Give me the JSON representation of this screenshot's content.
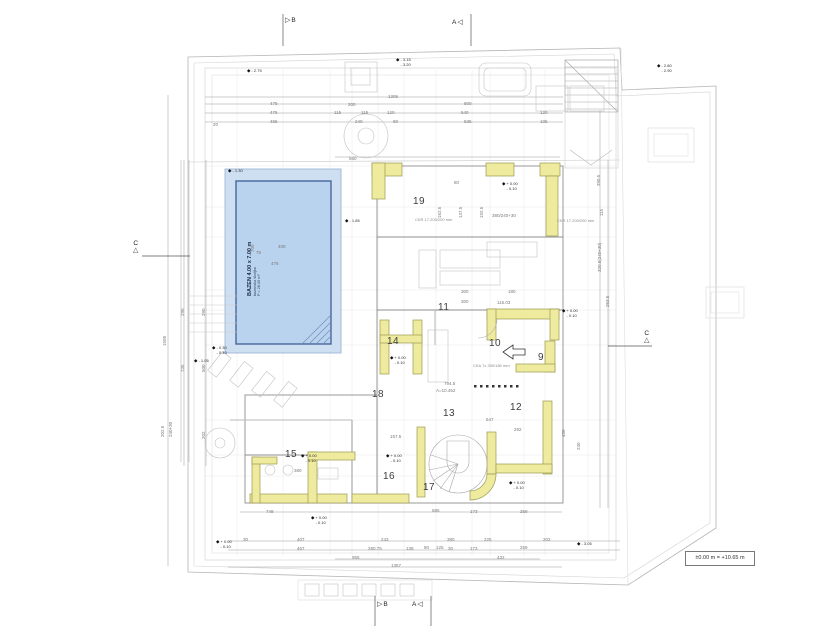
{
  "icons": {
    "level": "◆",
    "flag_right": "▷",
    "flag_left": "◁",
    "triangle_up": "△"
  },
  "drawing": {
    "pool": {
      "title": "BAZEN  4.00 x 7.00 m",
      "subtitle": "bazenska školjka",
      "area": "P = 28.00 m²"
    },
    "datum": {
      "label": "±0.00 m = +10.65 m"
    },
    "rooms": [
      {
        "n": "19",
        "x": 413,
        "y": 196
      },
      {
        "n": "11",
        "x": 438,
        "y": 302
      },
      {
        "n": "14",
        "x": 387,
        "y": 336
      },
      {
        "n": "10",
        "x": 489,
        "y": 338
      },
      {
        "n": "9",
        "x": 538,
        "y": 352
      },
      {
        "n": "18",
        "x": 372,
        "y": 389
      },
      {
        "n": "13",
        "x": 443,
        "y": 408
      },
      {
        "n": "12",
        "x": 510,
        "y": 402
      },
      {
        "n": "15",
        "x": 285,
        "y": 449
      },
      {
        "n": "16",
        "x": 383,
        "y": 471
      },
      {
        "n": "17",
        "x": 423,
        "y": 482
      }
    ],
    "section_markers": [
      {
        "label": "B",
        "icon": "flag_right",
        "x": 285,
        "y": 17
      },
      {
        "label": "A",
        "icon": "flag_left",
        "x": 452,
        "y": 19,
        "flip": true
      },
      {
        "label": "B",
        "icon": "flag_right",
        "x": 377,
        "y": 601
      },
      {
        "label": "A",
        "icon": "flag_left",
        "x": 412,
        "y": 601,
        "flip": true
      },
      {
        "label": "C",
        "icon": "triangle_up",
        "x": 133,
        "y": 240,
        "vert": true
      },
      {
        "label": "C",
        "icon": "triangle_up",
        "x": 644,
        "y": 330,
        "vert": true
      }
    ],
    "level_markers": [
      {
        "l1": "- 2.75",
        "x": 247,
        "y": 69
      },
      {
        "l1": "- 3.15",
        "l2": "- 3.20",
        "x": 396,
        "y": 58
      },
      {
        "l1": "- 2.80",
        "l2": "- 2.90",
        "x": 657,
        "y": 64
      },
      {
        "l1": "- 1.30",
        "x": 228,
        "y": 169
      },
      {
        "l1": "- 1.85",
        "x": 345,
        "y": 219
      },
      {
        "l1": "+ 0.00",
        "l2": "- 0.10",
        "x": 502,
        "y": 182
      },
      {
        "l1": "+ 0.00",
        "l2": "- 0.10",
        "x": 562,
        "y": 309
      },
      {
        "l1": "+ 0.00",
        "l2": "- 0.10",
        "x": 390,
        "y": 356
      },
      {
        "l1": "- 0.30",
        "l2": "- 0.40",
        "x": 212,
        "y": 346
      },
      {
        "l1": "- 1.05",
        "x": 194,
        "y": 359
      },
      {
        "l1": "+ 0.00",
        "l2": "- 0.10",
        "x": 301,
        "y": 454
      },
      {
        "l1": "+ 0.00",
        "l2": "- 0.10",
        "x": 386,
        "y": 454
      },
      {
        "l1": "+ 0.00",
        "l2": "- 0.10",
        "x": 509,
        "y": 481
      },
      {
        "l1": "+ 0.00",
        "l2": "- 0.10",
        "x": 311,
        "y": 516
      },
      {
        "l1": "- 3.05",
        "x": 577,
        "y": 542
      },
      {
        "l1": "+ 0.00",
        "l2": "- 0.10",
        "x": 216,
        "y": 540
      }
    ],
    "dims": [
      {
        "t": "1305",
        "x": 388,
        "y": 94
      },
      {
        "t": "475",
        "x": 270,
        "y": 101
      },
      {
        "t": "475",
        "x": 270,
        "y": 110
      },
      {
        "t": "455",
        "x": 270,
        "y": 119
      },
      {
        "t": "20",
        "x": 213,
        "y": 122
      },
      {
        "t": "200",
        "x": 348,
        "y": 102
      },
      {
        "t": "115",
        "x": 334,
        "y": 110
      },
      {
        "t": "115",
        "x": 361,
        "y": 110
      },
      {
        "t": "120",
        "x": 387,
        "y": 110
      },
      {
        "t": "240",
        "x": 355,
        "y": 119
      },
      {
        "t": "80",
        "x": 393,
        "y": 119
      },
      {
        "t": "800",
        "x": 464,
        "y": 101
      },
      {
        "t": "540",
        "x": 461,
        "y": 110
      },
      {
        "t": "535",
        "x": 464,
        "y": 119
      },
      {
        "t": "120",
        "x": 540,
        "y": 110
      },
      {
        "t": "105",
        "x": 540,
        "y": 119
      },
      {
        "t": "560",
        "x": 349,
        "y": 156
      },
      {
        "t": "80",
        "x": 454,
        "y": 180
      },
      {
        "t": "162.5",
        "x": 437,
        "y": 218,
        "r": 1
      },
      {
        "t": "137.5",
        "x": 458,
        "y": 218,
        "r": 1
      },
      {
        "t": "192.5",
        "x": 479,
        "y": 218,
        "r": 1
      },
      {
        "t": "380/240+30",
        "x": 492,
        "y": 213
      },
      {
        "t": "115.03",
        "x": 497,
        "y": 300
      },
      {
        "t": "300",
        "x": 461,
        "y": 289
      },
      {
        "t": "300",
        "x": 461,
        "y": 299
      },
      {
        "t": "180",
        "x": 508,
        "y": 289
      },
      {
        "t": "547",
        "x": 486,
        "y": 417
      },
      {
        "t": "292",
        "x": 514,
        "y": 427
      },
      {
        "t": "157.5",
        "x": 390,
        "y": 434
      },
      {
        "t": "380",
        "x": 294,
        "y": 468
      },
      {
        "t": "794.5",
        "x": 444,
        "y": 381
      },
      {
        "t": "A=10.452",
        "x": 436,
        "y": 388
      },
      {
        "t": "1508",
        "x": 162,
        "y": 346,
        "r": 1
      },
      {
        "t": "290",
        "x": 180,
        "y": 316,
        "r": 1
      },
      {
        "t": "290",
        "x": 201,
        "y": 316,
        "r": 1
      },
      {
        "t": "735",
        "x": 180,
        "y": 372,
        "r": 1
      },
      {
        "t": "500",
        "x": 201,
        "y": 372,
        "r": 1
      },
      {
        "t": "202.5",
        "x": 160,
        "y": 437,
        "r": 1
      },
      {
        "t": "240+30",
        "x": 168,
        "y": 437,
        "r": 1
      },
      {
        "t": "202",
        "x": 201,
        "y": 439,
        "r": 1
      },
      {
        "t": "700",
        "x": 250,
        "y": 252,
        "r": 1
      },
      {
        "t": "75",
        "x": 256,
        "y": 250
      },
      {
        "t": "400",
        "x": 278,
        "y": 244
      },
      {
        "t": "475",
        "x": 271,
        "y": 261
      },
      {
        "t": "390.5",
        "x": 596,
        "y": 186,
        "r": 1
      },
      {
        "t": "115",
        "x": 599,
        "y": 216,
        "r": 1
      },
      {
        "t": "320.5(240+30)",
        "x": 597,
        "y": 272,
        "r": 1
      },
      {
        "t": "263.5",
        "x": 605,
        "y": 307,
        "r": 1
      },
      {
        "t": "430",
        "x": 561,
        "y": 437,
        "r": 1
      },
      {
        "t": "240",
        "x": 576,
        "y": 450,
        "r": 1
      },
      {
        "t": "748",
        "x": 266,
        "y": 509
      },
      {
        "t": "685",
        "x": 432,
        "y": 508
      },
      {
        "t": "173",
        "x": 470,
        "y": 509
      },
      {
        "t": "259",
        "x": 520,
        "y": 509
      },
      {
        "t": "30",
        "x": 243,
        "y": 537
      },
      {
        "t": "407",
        "x": 297,
        "y": 537
      },
      {
        "t": "243",
        "x": 381,
        "y": 537
      },
      {
        "t": "380",
        "x": 447,
        "y": 537
      },
      {
        "t": "225",
        "x": 484,
        "y": 537
      },
      {
        "t": "202",
        "x": 543,
        "y": 537
      },
      {
        "t": "467",
        "x": 297,
        "y": 546
      },
      {
        "t": "280.75",
        "x": 368,
        "y": 546
      },
      {
        "t": "138",
        "x": 406,
        "y": 546
      },
      {
        "t": "80",
        "x": 424,
        "y": 545
      },
      {
        "t": "125",
        "x": 436,
        "y": 545
      },
      {
        "t": "30",
        "x": 448,
        "y": 546
      },
      {
        "t": "173",
        "x": 470,
        "y": 546
      },
      {
        "t": "259",
        "x": 520,
        "y": 545
      },
      {
        "t": "955",
        "x": 352,
        "y": 555
      },
      {
        "t": "432",
        "x": 497,
        "y": 555
      },
      {
        "t": "1357",
        "x": 391,
        "y": 563
      }
    ],
    "notes": [
      {
        "t": "CKR 17.200/200 mm",
        "x": 415,
        "y": 217
      },
      {
        "t": "CKR 17.200/200 mm",
        "x": 557,
        "y": 218
      },
      {
        "t": "CKA 7x 250/180 mm",
        "x": 473,
        "y": 363
      }
    ]
  }
}
